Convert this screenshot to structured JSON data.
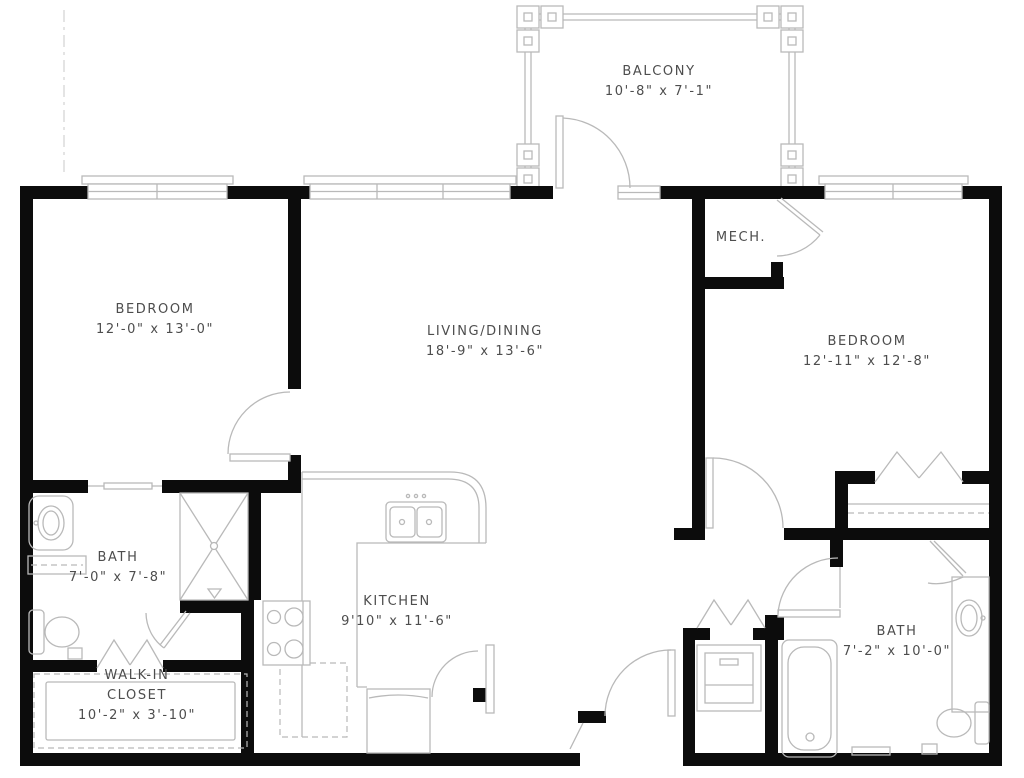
{
  "canvas": {
    "width_px": 1024,
    "height_px": 778
  },
  "colors": {
    "wall": "#0c0c0c",
    "fixture": "#b9b9b9",
    "fixture_light": "#d2d2d2",
    "text": "#4d4d4d",
    "background": "#ffffff"
  },
  "rooms": {
    "balcony": {
      "label": "BALCONY",
      "dims": "10'-8\" x 7'-1\""
    },
    "bedroom_left": {
      "label": "BEDROOM",
      "dims": "12'-0\" x 13'-0\""
    },
    "living_dining": {
      "label": "LIVING/DINING",
      "dims": "18'-9\" x 13'-6\""
    },
    "mech": {
      "label": "MECH."
    },
    "bedroom_right": {
      "label": "BEDROOM",
      "dims": "12'-11\" x 12'-8\""
    },
    "bath_left": {
      "label": "BATH",
      "dims": "7'-0\" x 7'-8\""
    },
    "kitchen": {
      "label": "KITCHEN",
      "dims": "9'10\" x 11'-6\""
    },
    "walk_in_closet": {
      "label": "WALK-IN",
      "label2": "CLOSET",
      "dims": "10'-2\" x 3'-10\""
    },
    "bath_right": {
      "label": "BATH",
      "dims": "7'-2\" x 10'-0\""
    }
  }
}
